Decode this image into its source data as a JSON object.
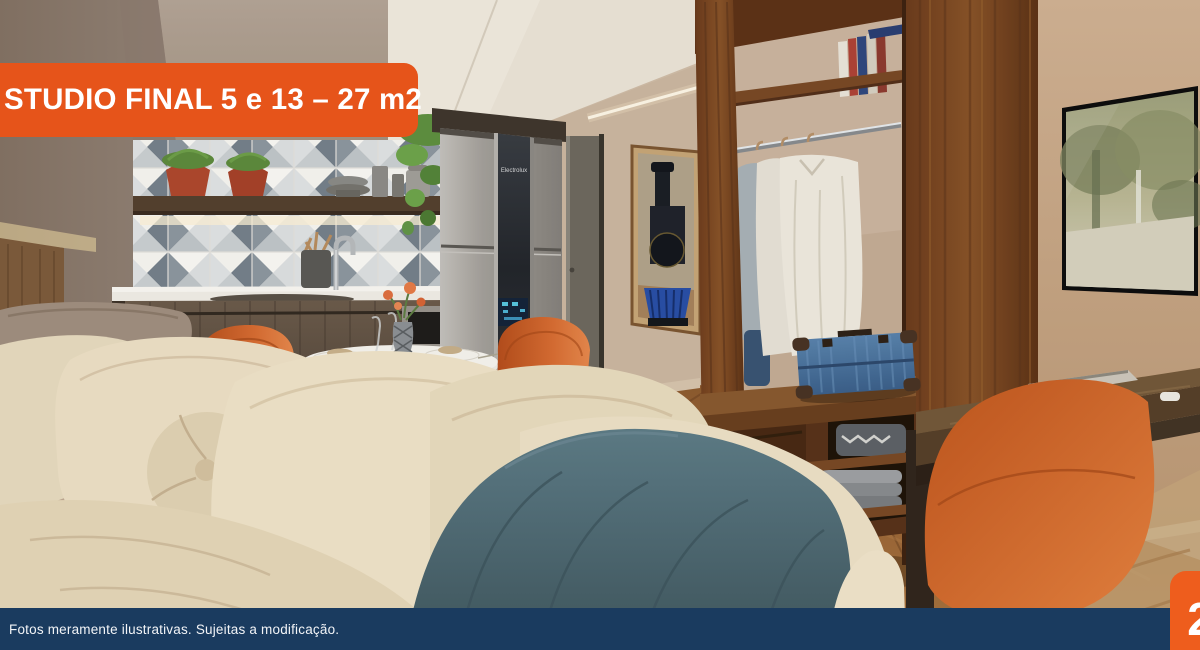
{
  "banner": {
    "title": "STUDIO FINAL 5 e 13 – 27 m2"
  },
  "footer": {
    "disclaimer": "Fotos meramente ilustrativas. Sujeitas a modificação."
  },
  "page_badge": {
    "number": "2"
  },
  "scene": {
    "fridge_brand": "Electrolux",
    "colors": {
      "banner_orange": "#E6541A",
      "badge_orange": "#EE5D1D",
      "footer_navy": "#1A3B5F",
      "chair_orange": "#D2622E",
      "blanket_teal": "#51707B",
      "wall_beige": "#C9B29E",
      "wood_brown": "#6E4528"
    }
  }
}
